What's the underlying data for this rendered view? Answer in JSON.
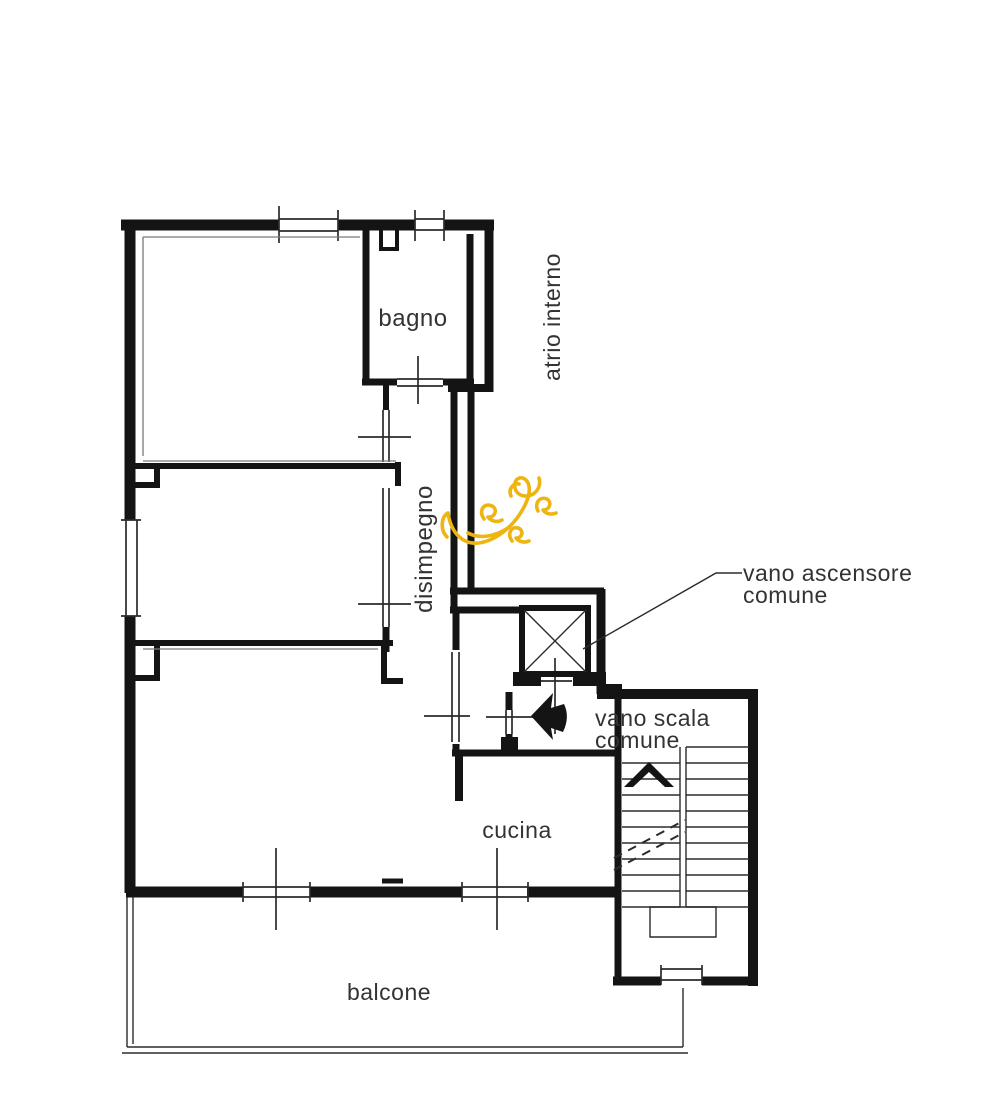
{
  "document": {
    "type": "architectural floor plan",
    "language": "Italian",
    "background": "#ffffff"
  },
  "colors": {
    "wall": "#141414",
    "line": "#2b2b2b",
    "grey_line": "#7a7a7a",
    "text": "#333333",
    "flourish_yellow": "#eeb412",
    "background": "#ffffff"
  },
  "labels": {
    "bagno": "bagno",
    "atrio_interno": "atrio interno",
    "disimpegno": "disimpegno",
    "vano_ascensore_line1": "vano ascensore",
    "vano_ascensore_line2": "comune",
    "vano_scala_line1": "vano scala",
    "vano_scala_line2": "comune",
    "cucina": "cucina",
    "balcone": "balcone"
  },
  "symbols": {
    "elevator_icon": "square-with-x-cross",
    "stairs_icon": "double-flight-treads-with-up-chevron-and-dashed-break",
    "entrance_arrow_icon": "solid-black-left-arrow",
    "door_icon": "thin-double-line-with-axis-tick",
    "window_icon": "double-parallel-thin-lines",
    "annotation_icon": "yellow-hand-drawn-flourish"
  }
}
